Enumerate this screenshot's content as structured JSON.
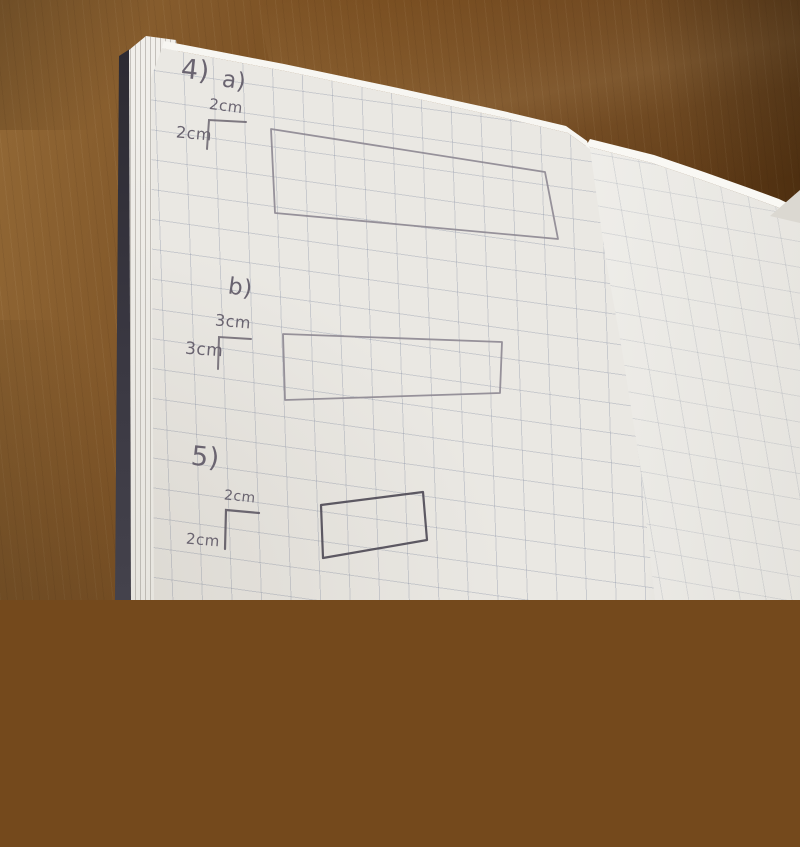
{
  "notebook": {
    "question4": {
      "label": "4)",
      "part_a": {
        "label": "a)",
        "top_dimension": "2cm",
        "side_dimension": "2cm"
      },
      "part_b": {
        "label": "b)",
        "top_dimension": "3cm",
        "side_dimension": "3cm"
      }
    },
    "question5": {
      "label": "5)",
      "top_dimension": "2cm",
      "side_dimension": "2cm"
    }
  },
  "colors": {
    "desk_wood": "#74491c",
    "paper_left": "#eae8e3",
    "paper_right": "#f1f0ec",
    "grid_line": "#7d879e",
    "pencil": "#6a6470",
    "dark_ink": "#54505b",
    "cover_edge": "#33313a"
  }
}
